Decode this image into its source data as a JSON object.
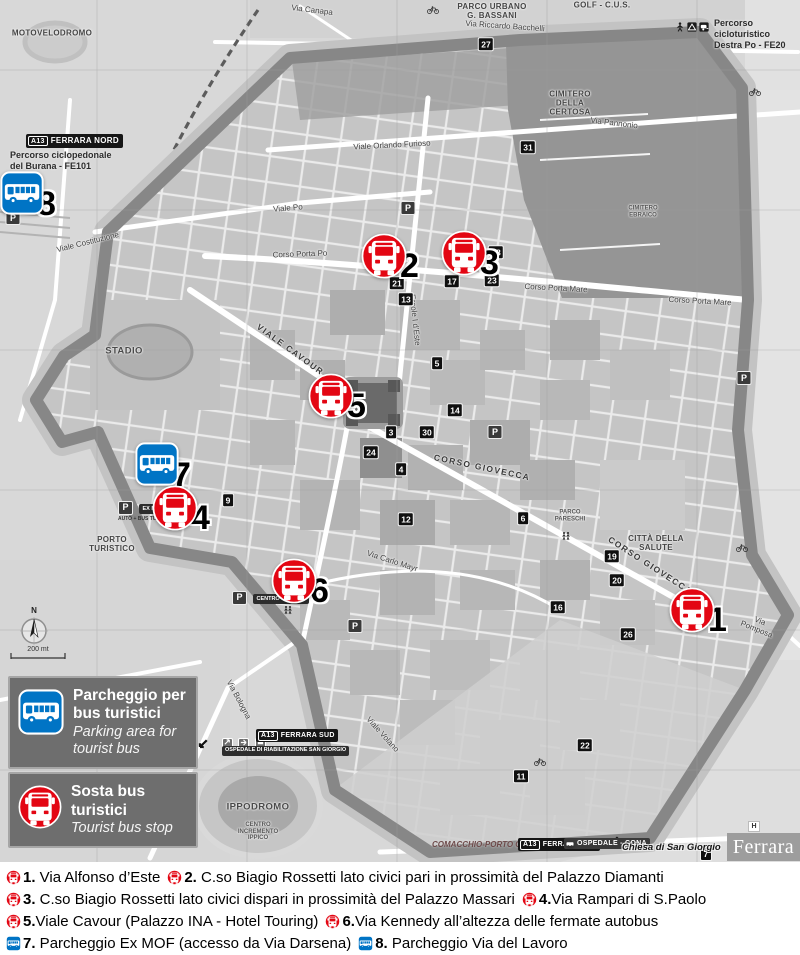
{
  "colors": {
    "stop_red": "#e30613",
    "parking_blue": "#0074c5",
    "wall_gray": "#878787"
  },
  "legend": {
    "parking_it": "Parcheggio per\nbus turistici",
    "parking_en": "Parking area for\ntourist bus",
    "stop_it": "Sosta bus\nturistici",
    "stop_en": "Tourist bus stop"
  },
  "markers": [
    {
      "id": "8",
      "type": "parking",
      "x": 28,
      "y": 196
    },
    {
      "id": "7",
      "type": "parking",
      "x": 163,
      "y": 467
    },
    {
      "id": "1",
      "type": "stop",
      "x": 698,
      "y": 612
    },
    {
      "id": "2",
      "type": "stop",
      "x": 390,
      "y": 258
    },
    {
      "id": "3",
      "type": "stop",
      "x": 470,
      "y": 255
    },
    {
      "id": "4",
      "type": "stop",
      "x": 181,
      "y": 510
    },
    {
      "id": "5",
      "type": "stop",
      "x": 337,
      "y": 398
    },
    {
      "id": "6",
      "type": "stop",
      "x": 300,
      "y": 583
    }
  ],
  "captions": [
    {
      "items": [
        {
          "type": "stop",
          "num": "1.",
          "text": " Via Alfonso d’Este"
        },
        {
          "type": "stop",
          "num": "2.",
          "text": " C.so Biagio Rossetti lato civici pari in prossimità del Palazzo Diamanti"
        }
      ]
    },
    {
      "items": [
        {
          "type": "stop",
          "num": "3.",
          "text": " C.so Biagio Rossetti lato civici dispari in prossimità del Palazzo Massari"
        },
        {
          "type": "stop",
          "num": "4.",
          "text": "Via Rampari di S.Paolo"
        }
      ]
    },
    {
      "items": [
        {
          "type": "stop",
          "num": "5.",
          "text": "Viale Cavour (Palazzo INA - Hotel Touring)"
        },
        {
          "type": "stop",
          "num": "6.",
          "text": "Via Kennedy all’altezza delle fermate autobus"
        }
      ]
    },
    {
      "items": [
        {
          "type": "parking",
          "num": "7.",
          "text": " Parcheggio Ex MOF (accesso da Via Darsena)"
        },
        {
          "type": "parking",
          "num": "8.",
          "text": " Parcheggio Via del Lavoro"
        }
      ]
    }
  ],
  "signs": {
    "a13": "A13",
    "ferrara_nord": "FERRARA NORD",
    "ferrara_sud": "FERRARA SUD",
    "burana": "Percorso ciclopedonale\ndel Burana - FE101",
    "destra_po": "Percorso cicloturistico\nDestra Po - FE20",
    "comacchio": "COMACCHIO-PORTO GARIBALDI /",
    "ospedale_cona": "OSPEDALE - CONA",
    "riabilitazione": "OSPEDALE DI RIABILITAZIONE SAN GIORGIO",
    "chiesa": "Chiesa di San Giorgio",
    "chiesa_badge": "7",
    "ex_mof": "EX MOF",
    "ex_mof_sub": "AUTO + BUS TURISTICI",
    "centro_storico": "CENTRO STORICO",
    "brand": "Ferrara",
    "h_badge": "H",
    "compass_n": "N",
    "scale": "200 mt",
    "p": "P"
  },
  "map_labels": [
    {
      "t": "MOTOVELODROMO",
      "x": 52,
      "y": 34,
      "r": 0,
      "c": "area-sm"
    },
    {
      "t": "Via Canapa",
      "x": 312,
      "y": 11,
      "r": 7,
      "c": "street"
    },
    {
      "t": "PARCO URBANO\nG. BASSANI",
      "x": 492,
      "y": 12,
      "r": 0,
      "c": "area-sm"
    },
    {
      "t": "GOLF - C.U.S.",
      "x": 602,
      "y": 6,
      "r": 0,
      "c": "area-sm"
    },
    {
      "t": "Via Riccardo Bacchelli",
      "x": 505,
      "y": 27,
      "r": 4,
      "c": "street"
    },
    {
      "t": "Viale Orlando Furioso",
      "x": 392,
      "y": 146,
      "r": -3,
      "c": "street"
    },
    {
      "t": "Via Pannonio",
      "x": 614,
      "y": 124,
      "r": 7,
      "c": "street"
    },
    {
      "t": "CIMITERO\nDELLA\nCERTOSA",
      "x": 570,
      "y": 104,
      "r": 0,
      "c": "area-sm"
    },
    {
      "t": "CIMITERO\nEBRAICO",
      "x": 643,
      "y": 212,
      "r": 0,
      "c": "area-xs"
    },
    {
      "t": "Viale Po",
      "x": 288,
      "y": 209,
      "r": -5,
      "c": "street"
    },
    {
      "t": "Corso Porta Po",
      "x": 300,
      "y": 255,
      "r": -2,
      "c": "street"
    },
    {
      "t": "Corso Porta Mare",
      "x": 556,
      "y": 289,
      "r": 3,
      "c": "street"
    },
    {
      "t": "Corso Porta Mare",
      "x": 700,
      "y": 302,
      "r": 3,
      "c": "street"
    },
    {
      "t": "VIALE CAVOUR",
      "x": 290,
      "y": 350,
      "r": 36,
      "c": "street-sp"
    },
    {
      "t": "Ercole I d’Este",
      "x": 414,
      "y": 320,
      "r": 84,
      "c": "street"
    },
    {
      "t": "CORSO GIOVECCA",
      "x": 482,
      "y": 468,
      "r": 12,
      "c": "street-sp"
    },
    {
      "t": "CORSO GIOVECCA",
      "x": 650,
      "y": 566,
      "r": 33,
      "c": "street-sp"
    },
    {
      "t": "Via Carlo Mayr",
      "x": 392,
      "y": 562,
      "r": 18,
      "c": "street"
    },
    {
      "t": "STADIO",
      "x": 124,
      "y": 352,
      "r": 0,
      "c": "area"
    },
    {
      "t": "PORTO\nTURISTICO",
      "x": 112,
      "y": 545,
      "r": 0,
      "c": "area-sm"
    },
    {
      "t": "IPPODROMO",
      "x": 258,
      "y": 808,
      "r": 0,
      "c": "area"
    },
    {
      "t": "CENTRO\nINCREMENTO\nIPPICO",
      "x": 258,
      "y": 832,
      "r": 0,
      "c": "area-xs"
    },
    {
      "t": "Via Bologna",
      "x": 238,
      "y": 700,
      "r": 62,
      "c": "street"
    },
    {
      "t": "Viale Volano",
      "x": 382,
      "y": 735,
      "r": 48,
      "c": "street"
    },
    {
      "t": "Via Pomposa",
      "x": 758,
      "y": 626,
      "r": 22,
      "c": "street"
    },
    {
      "t": "Viale Costituzione",
      "x": 88,
      "y": 243,
      "r": -14,
      "c": "street"
    },
    {
      "t": "CITTÀ DELLA\nSALUTE",
      "x": 656,
      "y": 544,
      "r": 0,
      "c": "area-sm"
    },
    {
      "t": "PARCO\nPARESCHI",
      "x": 570,
      "y": 516,
      "r": 0,
      "c": "area-xs"
    }
  ],
  "badges": [
    {
      "n": "27",
      "x": 486,
      "y": 44
    },
    {
      "n": "31",
      "x": 528,
      "y": 147
    },
    {
      "n": "18",
      "x": 496,
      "y": 252
    },
    {
      "n": "21",
      "x": 397,
      "y": 283
    },
    {
      "n": "13",
      "x": 406,
      "y": 299
    },
    {
      "n": "17",
      "x": 452,
      "y": 281
    },
    {
      "n": "23",
      "x": 492,
      "y": 280
    },
    {
      "n": "5",
      "x": 437,
      "y": 363
    },
    {
      "n": "14",
      "x": 455,
      "y": 410
    },
    {
      "n": "3",
      "x": 391,
      "y": 432
    },
    {
      "n": "30",
      "x": 427,
      "y": 432
    },
    {
      "n": "24",
      "x": 371,
      "y": 452
    },
    {
      "n": "4",
      "x": 401,
      "y": 469
    },
    {
      "n": "9",
      "x": 228,
      "y": 500
    },
    {
      "n": "12",
      "x": 406,
      "y": 519
    },
    {
      "n": "6",
      "x": 523,
      "y": 518
    },
    {
      "n": "19",
      "x": 612,
      "y": 556
    },
    {
      "n": "20",
      "x": 617,
      "y": 580
    },
    {
      "n": "16",
      "x": 558,
      "y": 607
    },
    {
      "n": "26",
      "x": 628,
      "y": 634
    },
    {
      "n": "22",
      "x": 585,
      "y": 745
    },
    {
      "n": "11",
      "x": 521,
      "y": 776
    }
  ],
  "p_badges": [
    {
      "x": 408,
      "y": 208
    },
    {
      "x": 495,
      "y": 432
    },
    {
      "x": 355,
      "y": 626
    },
    {
      "x": 744,
      "y": 378
    },
    {
      "x": 13,
      "y": 218
    }
  ],
  "decor": [
    {
      "k": "cyclist",
      "x": 433,
      "y": 10
    },
    {
      "k": "cyclist",
      "x": 755,
      "y": 92
    },
    {
      "k": "cyclist",
      "x": 742,
      "y": 548
    },
    {
      "k": "cyclist",
      "x": 540,
      "y": 762
    },
    {
      "k": "pedestrians",
      "x": 345,
      "y": 390
    },
    {
      "k": "pedestrians",
      "x": 566,
      "y": 536
    },
    {
      "k": "pedestrians",
      "x": 288,
      "y": 610
    },
    {
      "k": "hiker",
      "x": 680,
      "y": 27
    },
    {
      "k": "tent",
      "x": 692,
      "y": 27
    },
    {
      "k": "caravan",
      "x": 704,
      "y": 27
    },
    {
      "k": "arrow-nw",
      "x": 30,
      "y": 186
    },
    {
      "k": "arrow-sw",
      "x": 203,
      "y": 744
    },
    {
      "k": "arrow-sw",
      "x": 614,
      "y": 841
    }
  ]
}
